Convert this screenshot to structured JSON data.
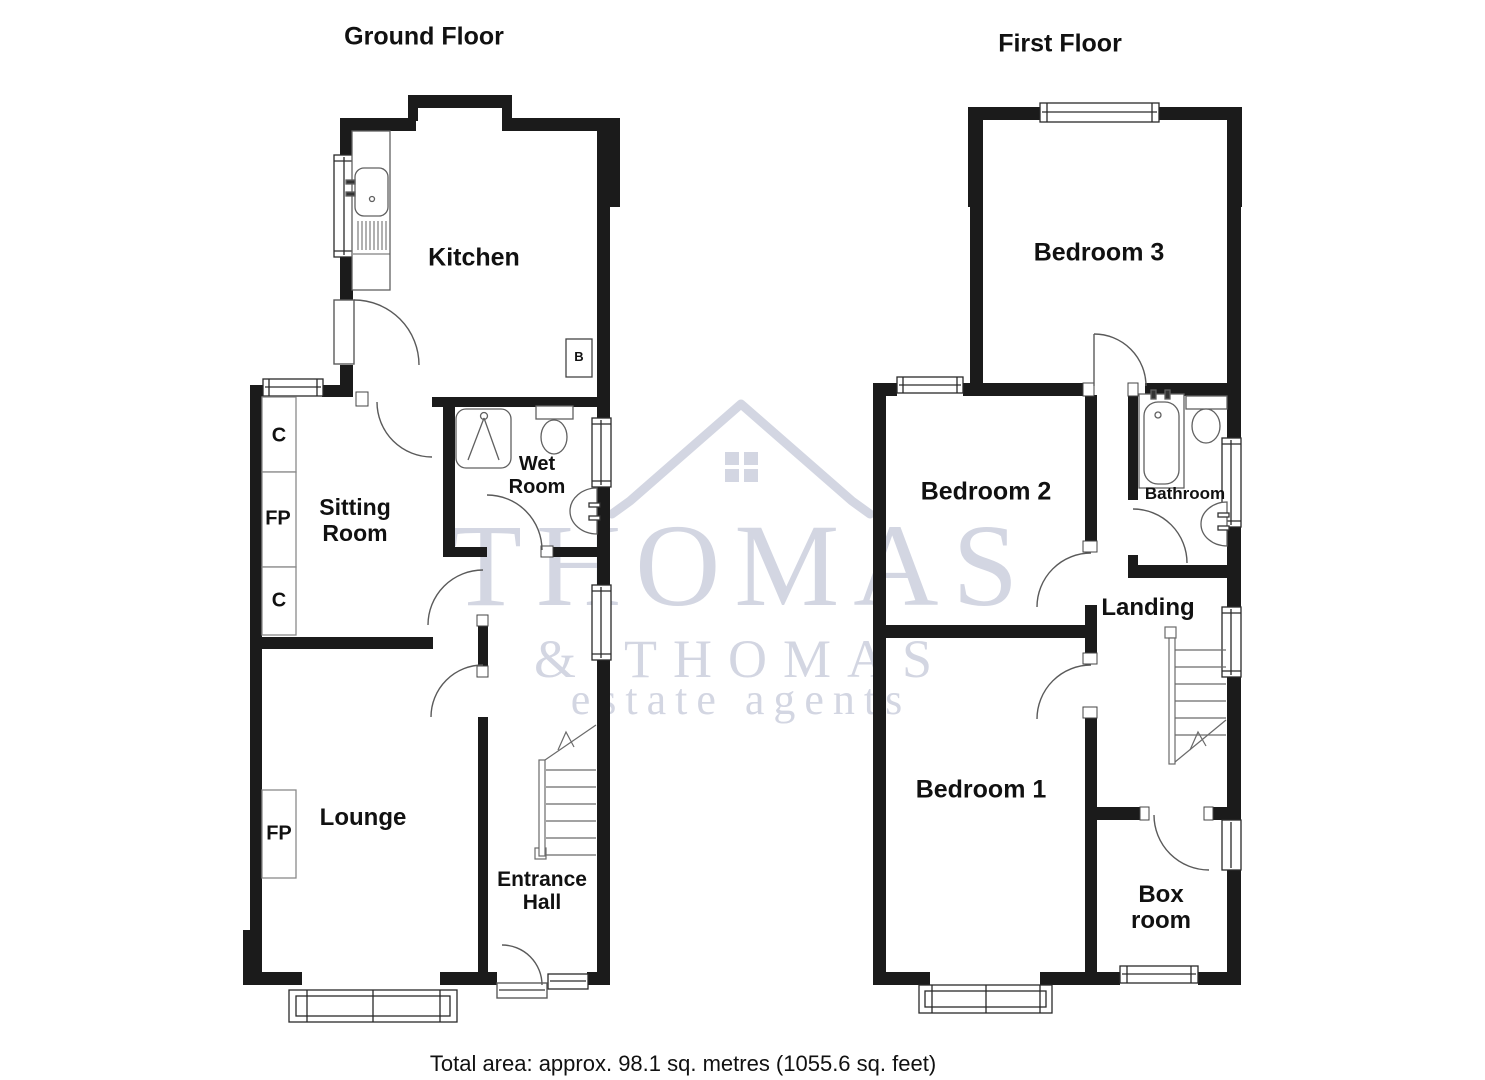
{
  "titles": {
    "ground": "Ground Floor",
    "first": "First Floor"
  },
  "footer": {
    "total_area": "Total area: approx. 98.1 sq. metres (1055.6 sq. feet)"
  },
  "watermark": {
    "brand_top": "THOMAS",
    "ampersand": "&",
    "brand_bottom": "THOMAS",
    "tagline": "estate agents",
    "color": "#d3d6e2",
    "icon": "house-roof-icon"
  },
  "ground": {
    "kitchen": "Kitchen",
    "boiler": "B",
    "wet_room": [
      "Wet",
      "Room"
    ],
    "sitting_room": [
      "Sitting",
      "Room"
    ],
    "cupboard_top": "C",
    "fireplace_sitting": "FP",
    "cupboard_bottom": "C",
    "lounge": "Lounge",
    "fireplace_lounge": "FP",
    "entrance_hall": [
      "Entrance",
      "Hall"
    ]
  },
  "first": {
    "bedroom3": "Bedroom 3",
    "bedroom2": "Bedroom 2",
    "bathroom": "Bathroom",
    "landing": "Landing",
    "bedroom1": "Bedroom 1",
    "box_room": [
      "Box",
      "room"
    ]
  },
  "fixture_icons": [
    "kitchen-sink-icon",
    "shower-tray-icon",
    "toilet-icon",
    "wash-basin-icon",
    "bath-icon",
    "stairs-icon",
    "bay-window-icon",
    "window-icon",
    "door-swing-icon"
  ]
}
